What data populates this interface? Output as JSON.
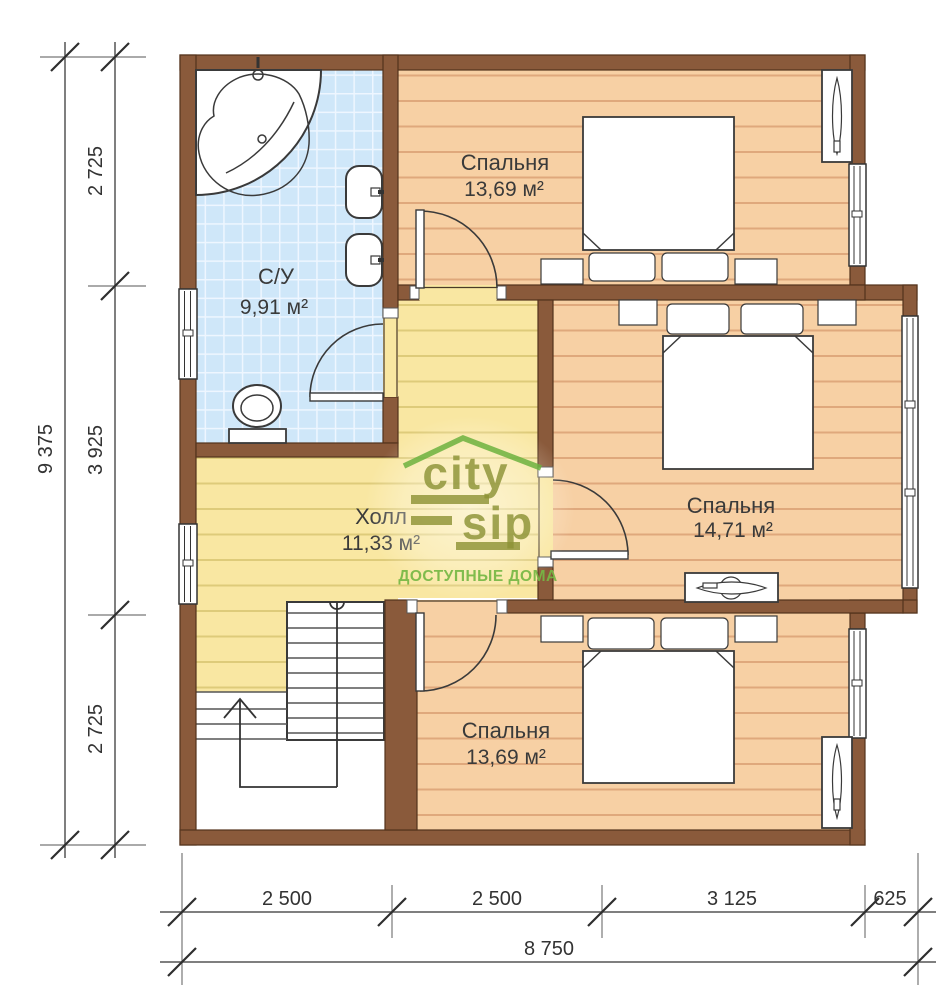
{
  "rooms": {
    "bedroom_top": {
      "name": "Спальня",
      "area": "13,69 м²"
    },
    "bathroom": {
      "name": "С/У",
      "area": "9,91 м²"
    },
    "hall": {
      "name": "Холл",
      "area": "11,33 м²"
    },
    "bedroom_middle": {
      "name": "Спальня",
      "area": "14,71 м²"
    },
    "bedroom_bottom": {
      "name": "Спальня",
      "area": "13,69 м²"
    }
  },
  "dimensions": {
    "left": {
      "segments": [
        "2 725",
        "3 925",
        "2 725"
      ],
      "total": "9 375"
    },
    "bottom": {
      "segments": [
        "2 500",
        "2 500",
        "3 125",
        "625"
      ],
      "total": "8 750"
    }
  },
  "logo": {
    "word1": "city",
    "word2": "sip",
    "tagline": "ДОСТУПНЫЕ ДОМА"
  },
  "colors": {
    "wall": "#8a5a3b",
    "wall_edge": "#53331c",
    "floor_orange": "#f7d0a4",
    "floor_orange_line": "#dfa87c",
    "floor_yellow": "#f9e7a2",
    "floor_yellow_line": "#decb7a",
    "tile_blue": "#cfe7f9",
    "tile_line": "#eef6ff",
    "logo_olive": "#8d9336",
    "logo_green": "#6cb23e",
    "logo_tagline": "#76b845"
  }
}
